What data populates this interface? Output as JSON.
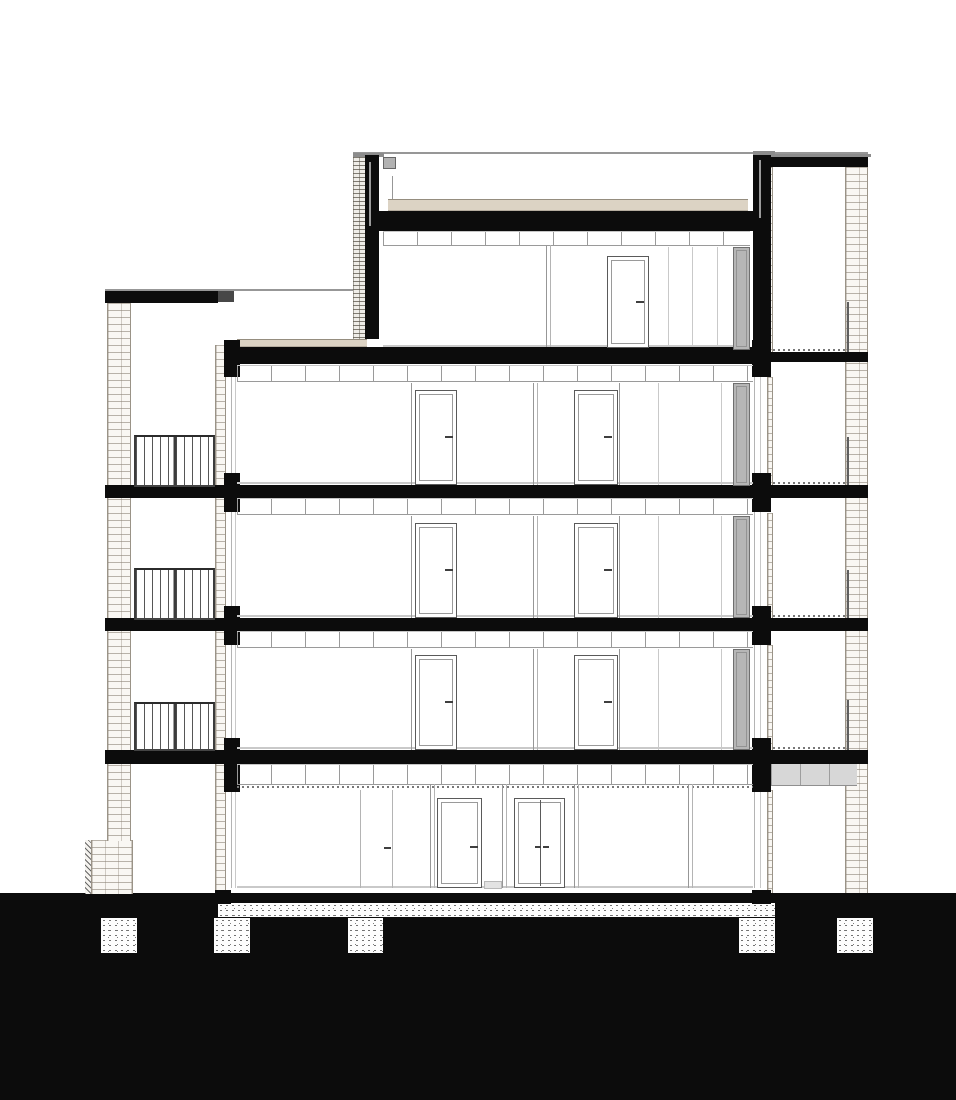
{
  "meta": {
    "drawing_kind": "architectural-building-cross-section",
    "view": "section-elevation",
    "floor_count": 5,
    "balcony_count": 3,
    "foundation_pad_count": 5,
    "has_text": false
  },
  "palette": {
    "paper": "#ffffff",
    "ink_black": "#0c0c0c",
    "brick_line": "#9a9387",
    "brick_bg": "#f9f7f3",
    "insulation_tan": "#dcd3c4",
    "gray_door_fill": "#b6b6b6",
    "ceiling_line": "#9a9a9a",
    "floor_finish_line": "#c9c9c9",
    "stipple_dot": "#282828",
    "canopy_gray": "#d7d7d7"
  },
  "elements": [
    {
      "name": "ground-mass",
      "cls": "blk",
      "x": 0,
      "y": 893,
      "w": 956,
      "h": 207
    },
    {
      "name": "ground-floor-slab-band",
      "cls": "stip",
      "x": 218,
      "y": 903,
      "w": 557,
      "h": 14
    },
    {
      "name": "foundation-pad-1",
      "cls": "stip",
      "x": 101,
      "y": 918,
      "w": 36,
      "h": 35
    },
    {
      "name": "foundation-pad-2",
      "cls": "stip",
      "x": 214,
      "y": 918,
      "w": 36,
      "h": 35
    },
    {
      "name": "foundation-pad-3",
      "cls": "stip",
      "x": 348,
      "y": 918,
      "w": 35,
      "h": 35
    },
    {
      "name": "foundation-pad-4",
      "cls": "stip",
      "x": 739,
      "y": 918,
      "w": 36,
      "h": 35
    },
    {
      "name": "foundation-pad-5",
      "cls": "stip",
      "x": 837,
      "y": 918,
      "w": 36,
      "h": 35
    },
    {
      "name": "left-footing-hatch",
      "cls": "hatchd",
      "x": 85,
      "y": 840,
      "w": 7,
      "h": 54
    },
    {
      "name": "left-footing-brick",
      "cls": "brick",
      "x": 91,
      "y": 840,
      "w": 42,
      "h": 54
    },
    {
      "name": "left-brick-wall",
      "cls": "brick",
      "x": 107,
      "y": 303,
      "w": 24,
      "h": 538
    },
    {
      "name": "left-facade-brick-strip",
      "cls": "brick",
      "x": 215,
      "y": 345,
      "w": 11,
      "h": 548
    },
    {
      "name": "left-facade-glass-line-a",
      "cls": "lb",
      "x": 231,
      "y": 345,
      "w": 1,
      "h": 543
    },
    {
      "name": "left-facade-glass-line-b",
      "cls": "lc",
      "x": 235,
      "y": 345,
      "w": 1,
      "h": 543
    },
    {
      "name": "right-brick-wall",
      "cls": "brick",
      "x": 845,
      "y": 167,
      "w": 23,
      "h": 726
    },
    {
      "name": "right-inner-brick-1",
      "cls": "brick",
      "x": 767,
      "y": 167,
      "w": 6,
      "h": 185
    },
    {
      "name": "right-inner-brick-2",
      "cls": "brick",
      "x": 767,
      "y": 377,
      "w": 6,
      "h": 108
    },
    {
      "name": "right-inner-brick-3",
      "cls": "brick",
      "x": 767,
      "y": 513,
      "w": 6,
      "h": 105
    },
    {
      "name": "right-inner-brick-4",
      "cls": "brick",
      "x": 767,
      "y": 645,
      "w": 6,
      "h": 105
    },
    {
      "name": "right-inner-brick-5",
      "cls": "brick",
      "x": 767,
      "y": 790,
      "w": 6,
      "h": 103
    },
    {
      "name": "right-facade-glass-line-a",
      "cls": "lb",
      "x": 754,
      "y": 245,
      "w": 1,
      "h": 643
    },
    {
      "name": "right-facade-glass-line-b",
      "cls": "lc",
      "x": 760,
      "y": 245,
      "w": 1,
      "h": 643
    },
    {
      "name": "roof-parapet-elevation-line",
      "cls": "l9",
      "x": 353,
      "y": 152,
      "w": 515,
      "h": 2
    },
    {
      "name": "right-tower-coping",
      "cls": "coping",
      "x": 771,
      "y": 154,
      "w": 100,
      "h": 3
    },
    {
      "name": "right-tower-roof-slab",
      "cls": "blk",
      "x": 771,
      "y": 157,
      "w": 97,
      "h": 10
    },
    {
      "name": "penthouse-parapet-cap-left",
      "cls": "coping",
      "x": 353,
      "y": 153,
      "w": 31,
      "h": 4
    },
    {
      "name": "penthouse-parapet-brick-left",
      "cls": "brickd",
      "x": 353,
      "y": 157,
      "w": 12,
      "h": 182
    },
    {
      "name": "penthouse-parapet-left",
      "cls": "blk",
      "x": 365,
      "y": 155,
      "w": 14,
      "h": 184
    },
    {
      "name": "roof-drain-pipe-left",
      "cls": "pipe",
      "x": 369,
      "y": 162,
      "w": 2,
      "h": 64
    },
    {
      "name": "roof-drain-box",
      "cls": "box",
      "x": 383,
      "y": 157,
      "w": 13,
      "h": 12
    },
    {
      "name": "roof-vent-line",
      "cls": "l9",
      "x": 392,
      "y": 176,
      "w": 1,
      "h": 23
    },
    {
      "name": "roof-insulation-band",
      "cls": "tan",
      "x": 388,
      "y": 199,
      "w": 360,
      "h": 12
    },
    {
      "name": "penthouse-roof-slab",
      "cls": "blk",
      "x": 379,
      "y": 211,
      "w": 376,
      "h": 20
    },
    {
      "name": "penthouse-parapet-right",
      "cls": "blk",
      "x": 753,
      "y": 155,
      "w": 18,
      "h": 197
    },
    {
      "name": "penthouse-parapet-cap-right",
      "cls": "coping",
      "x": 753,
      "y": 151,
      "w": 22,
      "h": 4
    },
    {
      "name": "roof-drain-pipe-right",
      "cls": "pipe",
      "x": 759,
      "y": 160,
      "w": 2,
      "h": 58
    },
    {
      "name": "left-wing-roof-coping",
      "cls": "l9",
      "x": 105,
      "y": 289,
      "w": 113,
      "h": 2
    },
    {
      "name": "left-wing-roof-cap",
      "cls": "blk",
      "x": 105,
      "y": 291,
      "w": 113,
      "h": 12
    },
    {
      "name": "left-wing-junction-block",
      "cls": "blk2",
      "x": 218,
      "y": 291,
      "w": 16,
      "h": 11
    },
    {
      "name": "left-wing-roofline-elevation",
      "cls": "l9",
      "x": 218,
      "y": 289,
      "w": 135,
      "h": 2
    },
    {
      "name": "terrace-deck-band",
      "cls": "tan",
      "x": 237,
      "y": 339,
      "w": 130,
      "h": 8
    },
    {
      "name": "terrace-floor-slab",
      "cls": "blk",
      "x": 228,
      "y": 347,
      "w": 525,
      "h": 17
    },
    {
      "name": "right-tower-terrace-slab",
      "cls": "blk",
      "x": 765,
      "y": 352,
      "w": 103,
      "h": 10
    },
    {
      "name": "floor-slab-level3",
      "cls": "blk",
      "x": 228,
      "y": 485,
      "w": 640,
      "h": 13
    },
    {
      "name": "floor-slab-level2",
      "cls": "blk",
      "x": 228,
      "y": 618,
      "w": 640,
      "h": 13
    },
    {
      "name": "floor-slab-level1",
      "cls": "blk",
      "x": 228,
      "y": 750,
      "w": 640,
      "h": 14
    },
    {
      "name": "balcony-slab-level3",
      "cls": "blk",
      "x": 105,
      "y": 485,
      "w": 123,
      "h": 13
    },
    {
      "name": "balcony-slab-level2",
      "cls": "blk",
      "x": 105,
      "y": 618,
      "w": 123,
      "h": 13
    },
    {
      "name": "balcony-slab-level1",
      "cls": "blk",
      "x": 105,
      "y": 750,
      "w": 123,
      "h": 14
    },
    {
      "name": "left-facade-beam-3",
      "cls": "blk",
      "x": 224,
      "y": 340,
      "w": 16,
      "h": 37
    },
    {
      "name": "left-facade-beam-2",
      "cls": "blk",
      "x": 224,
      "y": 473,
      "w": 16,
      "h": 39
    },
    {
      "name": "left-facade-beam-1",
      "cls": "blk",
      "x": 224,
      "y": 606,
      "w": 16,
      "h": 39
    },
    {
      "name": "left-facade-beam-0",
      "cls": "blk",
      "x": 224,
      "y": 738,
      "w": 16,
      "h": 54
    },
    {
      "name": "right-facade-beam-3",
      "cls": "blk",
      "x": 752,
      "y": 340,
      "w": 19,
      "h": 37
    },
    {
      "name": "right-facade-beam-2",
      "cls": "blk",
      "x": 752,
      "y": 473,
      "w": 19,
      "h": 39
    },
    {
      "name": "right-facade-beam-1",
      "cls": "blk",
      "x": 752,
      "y": 606,
      "w": 19,
      "h": 39
    },
    {
      "name": "right-facade-beam-0",
      "cls": "blk",
      "x": 752,
      "y": 738,
      "w": 19,
      "h": 54
    },
    {
      "name": "left-wall-base-stub",
      "cls": "blk",
      "x": 215,
      "y": 890,
      "w": 16,
      "h": 14
    },
    {
      "name": "right-wall-base-stub",
      "cls": "blk",
      "x": 752,
      "y": 890,
      "w": 19,
      "h": 14
    },
    {
      "name": "ceiling-band-penthouse",
      "cls": "tickband",
      "x": 383,
      "y": 231,
      "w": 367,
      "h": 15
    },
    {
      "name": "ceiling-band-level3",
      "cls": "tickband",
      "x": 237,
      "y": 365,
      "w": 516,
      "h": 17
    },
    {
      "name": "ceiling-band-level2",
      "cls": "tickband",
      "x": 237,
      "y": 498,
      "w": 516,
      "h": 17
    },
    {
      "name": "ceiling-band-level1",
      "cls": "tickband",
      "x": 237,
      "y": 631,
      "w": 516,
      "h": 17
    },
    {
      "name": "ceiling-band-ground",
      "cls": "tickband",
      "x": 237,
      "y": 764,
      "w": 516,
      "h": 21
    },
    {
      "name": "ground-ceiling-dotted-line",
      "cls": "dot2",
      "x": 237,
      "y": 786,
      "w": 516,
      "h": 2
    },
    {
      "name": "floor-finish-level3",
      "cls": "lc",
      "x": 237,
      "y": 482,
      "w": 516,
      "h": 2
    },
    {
      "name": "floor-finish-level2",
      "cls": "lc",
      "x": 237,
      "y": 615,
      "w": 516,
      "h": 2
    },
    {
      "name": "floor-finish-level1",
      "cls": "lc",
      "x": 237,
      "y": 747,
      "w": 516,
      "h": 2
    },
    {
      "name": "floor-finish-ground",
      "cls": "lc",
      "x": 237,
      "y": 886,
      "w": 516,
      "h": 2
    },
    {
      "name": "floor-finish-penthouse",
      "cls": "lc",
      "x": 383,
      "y": 345,
      "w": 367,
      "h": 2
    },
    {
      "name": "loggia-dotted-top",
      "cls": "dot2",
      "x": 773,
      "y": 349,
      "w": 72,
      "h": 2
    },
    {
      "name": "loggia-dotted-3",
      "cls": "dot2",
      "x": 773,
      "y": 482,
      "w": 72,
      "h": 2
    },
    {
      "name": "loggia-dotted-2",
      "cls": "dot2",
      "x": 773,
      "y": 615,
      "w": 72,
      "h": 2
    },
    {
      "name": "loggia-dotted-1",
      "cls": "dot2",
      "x": 773,
      "y": 747,
      "w": 72,
      "h": 2
    },
    {
      "name": "loggia-railing-top",
      "cls": "l6",
      "x": 847,
      "y": 302,
      "w": 2,
      "h": 50
    },
    {
      "name": "loggia-railing-3",
      "cls": "l6",
      "x": 847,
      "y": 437,
      "w": 2,
      "h": 48
    },
    {
      "name": "loggia-railing-2",
      "cls": "l6",
      "x": 847,
      "y": 570,
      "w": 2,
      "h": 48
    },
    {
      "name": "loggia-railing-1",
      "cls": "l6",
      "x": 847,
      "y": 700,
      "w": 2,
      "h": 50
    },
    {
      "name": "entrance-canopy",
      "cls": "canopy",
      "x": 771,
      "y": 764,
      "w": 86,
      "h": 22
    },
    {
      "name": "balcony-railing-level3",
      "cls": "rail",
      "x": 134,
      "y": 435,
      "w": 81,
      "h": 52
    },
    {
      "name": "balcony-railing-level2",
      "cls": "rail",
      "x": 134,
      "y": 568,
      "w": 81,
      "h": 52
    },
    {
      "name": "balcony-railing-level1",
      "cls": "rail",
      "x": 134,
      "y": 702,
      "w": 81,
      "h": 49
    },
    {
      "name": "wall-line-l3-a",
      "cls": "l9",
      "x": 411,
      "y": 383,
      "w": 1,
      "h": 102
    },
    {
      "name": "partition-l3-a",
      "cls": "l9",
      "x": 533,
      "y": 383,
      "w": 1,
      "h": 102
    },
    {
      "name": "partition-l3-b",
      "cls": "lb",
      "x": 537,
      "y": 383,
      "w": 1,
      "h": 102
    },
    {
      "name": "wall-line-l3-b",
      "cls": "l9",
      "x": 619,
      "y": 383,
      "w": 1,
      "h": 102
    },
    {
      "name": "elev-line-l3-a",
      "cls": "lc",
      "x": 658,
      "y": 383,
      "w": 1,
      "h": 102
    },
    {
      "name": "elev-line-l3-b",
      "cls": "lc",
      "x": 721,
      "y": 383,
      "w": 1,
      "h": 102
    },
    {
      "name": "wall-line-l2-a",
      "cls": "l9",
      "x": 411,
      "y": 516,
      "w": 1,
      "h": 102
    },
    {
      "name": "partition-l2-a",
      "cls": "l9",
      "x": 533,
      "y": 516,
      "w": 1,
      "h": 102
    },
    {
      "name": "partition-l2-b",
      "cls": "lb",
      "x": 537,
      "y": 516,
      "w": 1,
      "h": 102
    },
    {
      "name": "wall-line-l2-b",
      "cls": "l9",
      "x": 619,
      "y": 516,
      "w": 1,
      "h": 102
    },
    {
      "name": "elev-line-l2-a",
      "cls": "lc",
      "x": 658,
      "y": 516,
      "w": 1,
      "h": 102
    },
    {
      "name": "elev-line-l2-b",
      "cls": "lc",
      "x": 721,
      "y": 516,
      "w": 1,
      "h": 102
    },
    {
      "name": "wall-line-l1-a",
      "cls": "l9",
      "x": 411,
      "y": 649,
      "w": 1,
      "h": 101
    },
    {
      "name": "partition-l1-a",
      "cls": "l9",
      "x": 533,
      "y": 649,
      "w": 1,
      "h": 101
    },
    {
      "name": "partition-l1-b",
      "cls": "lb",
      "x": 537,
      "y": 649,
      "w": 1,
      "h": 101
    },
    {
      "name": "wall-line-l1-b",
      "cls": "l9",
      "x": 619,
      "y": 649,
      "w": 1,
      "h": 101
    },
    {
      "name": "elev-line-l1-a",
      "cls": "lc",
      "x": 658,
      "y": 649,
      "w": 1,
      "h": 101
    },
    {
      "name": "elev-line-l1-b",
      "cls": "lc",
      "x": 721,
      "y": 649,
      "w": 1,
      "h": 101
    },
    {
      "name": "partition-pent-a",
      "cls": "l9",
      "x": 546,
      "y": 245,
      "w": 1,
      "h": 102
    },
    {
      "name": "partition-pent-b",
      "cls": "lb",
      "x": 550,
      "y": 245,
      "w": 1,
      "h": 102
    },
    {
      "name": "elev-line-pent-a",
      "cls": "lc",
      "x": 668,
      "y": 247,
      "w": 1,
      "h": 100
    },
    {
      "name": "elev-line-pent-b",
      "cls": "lc",
      "x": 692,
      "y": 247,
      "w": 1,
      "h": 100
    },
    {
      "name": "elev-line-pent-c",
      "cls": "lc",
      "x": 717,
      "y": 247,
      "w": 1,
      "h": 100
    },
    {
      "name": "glass-door-line-ground-a",
      "cls": "lb",
      "x": 360,
      "y": 790,
      "w": 1,
      "h": 98
    },
    {
      "name": "glass-door-line-ground-b",
      "cls": "lb",
      "x": 392,
      "y": 790,
      "w": 1,
      "h": 98
    },
    {
      "name": "wall-line-ground-a",
      "cls": "l9",
      "x": 430,
      "y": 784,
      "w": 1,
      "h": 104
    },
    {
      "name": "wall-line-ground-b",
      "cls": "lb",
      "x": 434,
      "y": 784,
      "w": 1,
      "h": 104
    },
    {
      "name": "partition-ground-1a",
      "cls": "l9",
      "x": 502,
      "y": 784,
      "w": 1,
      "h": 104
    },
    {
      "name": "partition-ground-1b",
      "cls": "lb",
      "x": 506,
      "y": 784,
      "w": 1,
      "h": 104
    },
    {
      "name": "partition-ground-2a",
      "cls": "l9",
      "x": 574,
      "y": 784,
      "w": 1,
      "h": 104
    },
    {
      "name": "partition-ground-2b",
      "cls": "lb",
      "x": 578,
      "y": 784,
      "w": 1,
      "h": 104
    },
    {
      "name": "partition-ground-3a",
      "cls": "l9",
      "x": 688,
      "y": 784,
      "w": 1,
      "h": 104
    },
    {
      "name": "partition-ground-3b",
      "cls": "lb",
      "x": 692,
      "y": 784,
      "w": 1,
      "h": 104
    },
    {
      "name": "door-l3-left",
      "cls": "door",
      "x": 415,
      "y": 390,
      "w": 42,
      "h": 95
    },
    {
      "name": "door-l3-right",
      "cls": "door",
      "x": 574,
      "y": 390,
      "w": 44,
      "h": 95
    },
    {
      "name": "door-l2-left",
      "cls": "door",
      "x": 415,
      "y": 523,
      "w": 42,
      "h": 95
    },
    {
      "name": "door-l2-right",
      "cls": "door",
      "x": 574,
      "y": 523,
      "w": 44,
      "h": 95
    },
    {
      "name": "door-l1-left",
      "cls": "door",
      "x": 415,
      "y": 655,
      "w": 42,
      "h": 95
    },
    {
      "name": "door-l1-right",
      "cls": "door",
      "x": 574,
      "y": 655,
      "w": 44,
      "h": 95
    },
    {
      "name": "door-penthouse",
      "cls": "door",
      "x": 607,
      "y": 256,
      "w": 42,
      "h": 92
    },
    {
      "name": "door-ground-single",
      "cls": "door",
      "x": 437,
      "y": 798,
      "w": 45,
      "h": 90
    },
    {
      "name": "door-ground-double",
      "cls": "ddoor",
      "x": 514,
      "y": 798,
      "w": 51,
      "h": 90
    },
    {
      "name": "loggia-door-penthouse",
      "cls": "gdoor",
      "x": 733,
      "y": 247,
      "w": 17,
      "h": 103
    },
    {
      "name": "loggia-door-l3",
      "cls": "gdoor",
      "x": 733,
      "y": 383,
      "w": 17,
      "h": 103
    },
    {
      "name": "loggia-door-l2",
      "cls": "gdoor",
      "x": 733,
      "y": 516,
      "w": 17,
      "h": 102
    },
    {
      "name": "loggia-door-l1",
      "cls": "gdoor",
      "x": 733,
      "y": 649,
      "w": 17,
      "h": 101
    },
    {
      "name": "entrance-mat",
      "cls": "mat",
      "x": 484,
      "y": 881,
      "w": 18,
      "h": 8
    },
    {
      "name": "handle-l3-left",
      "cls": "handle",
      "x": 445,
      "y": 436,
      "w": 8,
      "h": 2
    },
    {
      "name": "handle-l3-right",
      "cls": "handle",
      "x": 604,
      "y": 436,
      "w": 8,
      "h": 2
    },
    {
      "name": "handle-l2-left",
      "cls": "handle",
      "x": 445,
      "y": 569,
      "w": 8,
      "h": 2
    },
    {
      "name": "handle-l2-right",
      "cls": "handle",
      "x": 604,
      "y": 569,
      "w": 8,
      "h": 2
    },
    {
      "name": "handle-l1-left",
      "cls": "handle",
      "x": 445,
      "y": 701,
      "w": 8,
      "h": 2
    },
    {
      "name": "handle-l1-right",
      "cls": "handle",
      "x": 604,
      "y": 701,
      "w": 8,
      "h": 2
    },
    {
      "name": "handle-penthouse",
      "cls": "handle",
      "x": 636,
      "y": 301,
      "w": 8,
      "h": 2
    },
    {
      "name": "handle-ground-single",
      "cls": "handle",
      "x": 470,
      "y": 846,
      "w": 8,
      "h": 2
    },
    {
      "name": "handle-ground-double-l",
      "cls": "handle",
      "x": 535,
      "y": 846,
      "w": 6,
      "h": 2
    },
    {
      "name": "handle-ground-double-r",
      "cls": "handle",
      "x": 543,
      "y": 846,
      "w": 6,
      "h": 2
    },
    {
      "name": "handle-ground-glass",
      "cls": "handle",
      "x": 384,
      "y": 847,
      "w": 7,
      "h": 2
    }
  ]
}
